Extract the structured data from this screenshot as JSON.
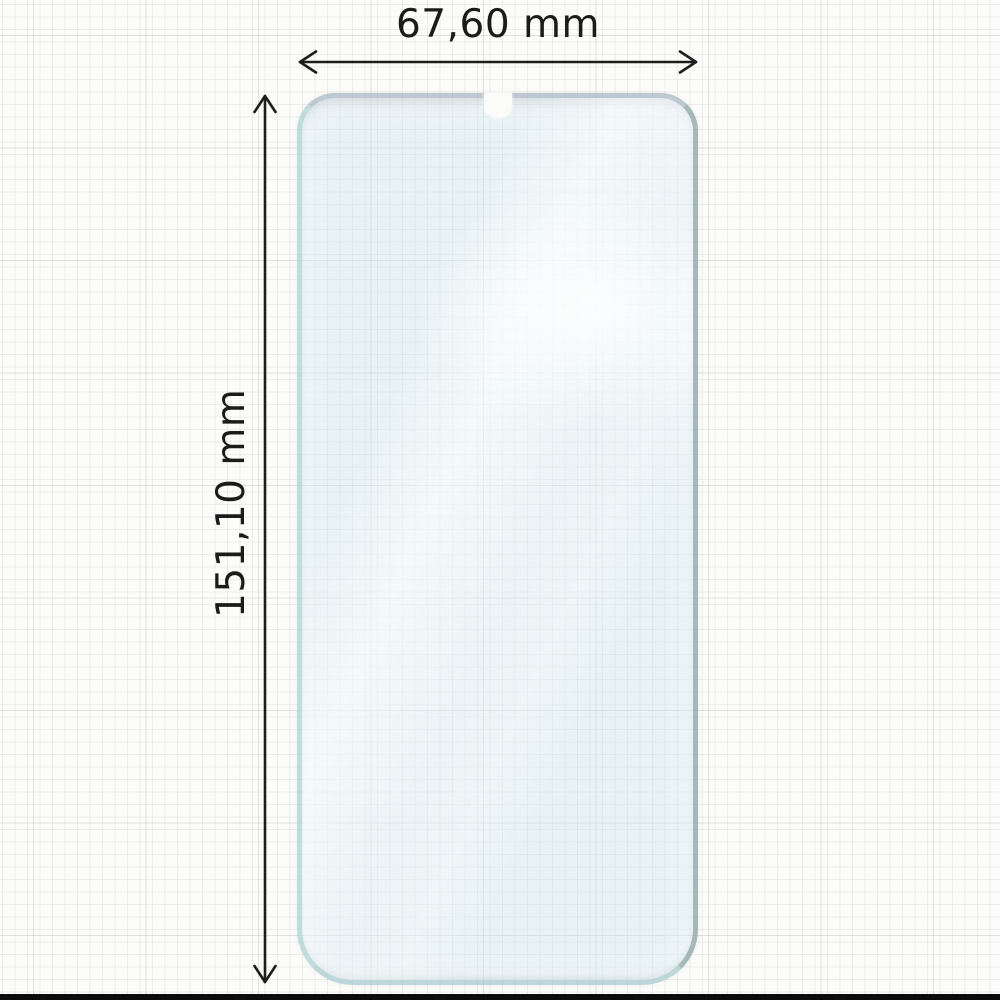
{
  "diagram": {
    "width_label": "67,60 mm",
    "height_label": "151,10 mm"
  },
  "icons": {
    "width_arrow": "double-headed-horizontal-arrow",
    "height_arrow": "double-headed-vertical-arrow",
    "notch": "waterdrop-notch"
  },
  "colors": {
    "paper": "#fcfcfa",
    "grid_minor": "#ececea",
    "grid_major": "#d9d9d7",
    "film_tint": "#cae6ee",
    "film_edge_teal": "#a8cecf",
    "film_edge_gray": "#7e9395",
    "arrow_ink": "#1d1d1d",
    "bottom_edge": "#0c0c0c"
  }
}
